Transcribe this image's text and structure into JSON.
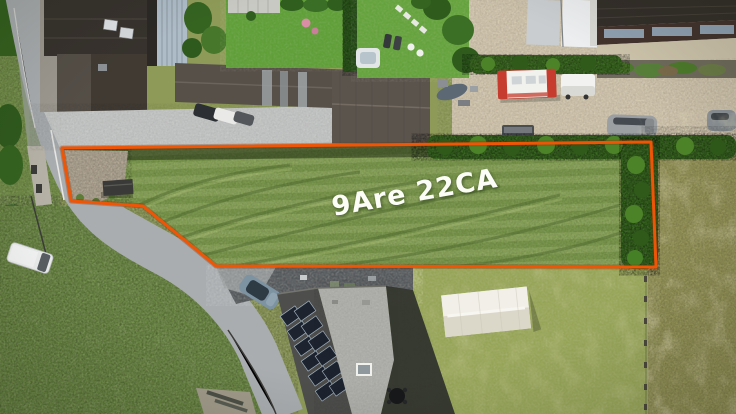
{
  "image": {
    "area_label": "9Are 22CA"
  },
  "colors": {
    "boundary_orange": "#ee5507",
    "plot_lawn_green": "#7f9c4e",
    "garden_green": "#5f9e38",
    "meadow_green": "#6d8b44",
    "field_yellow_green": "#96a458",
    "dry_field_olive": "#99985c",
    "road_gray": "#a9adb0",
    "gravel_beige": "#d2c6ae",
    "asphalt_dark": "#55585b",
    "roof_dark": "#37322d",
    "barn_roof_brown": "#575049",
    "metal_roof_blue": "#aebcc8",
    "hedge_green": "#3b6a22",
    "solar_panel_blue": "#1d2430",
    "tent_white": "#e9e6dc",
    "truck_red": "#c63c2e",
    "label_white": "#fbfdf6"
  }
}
